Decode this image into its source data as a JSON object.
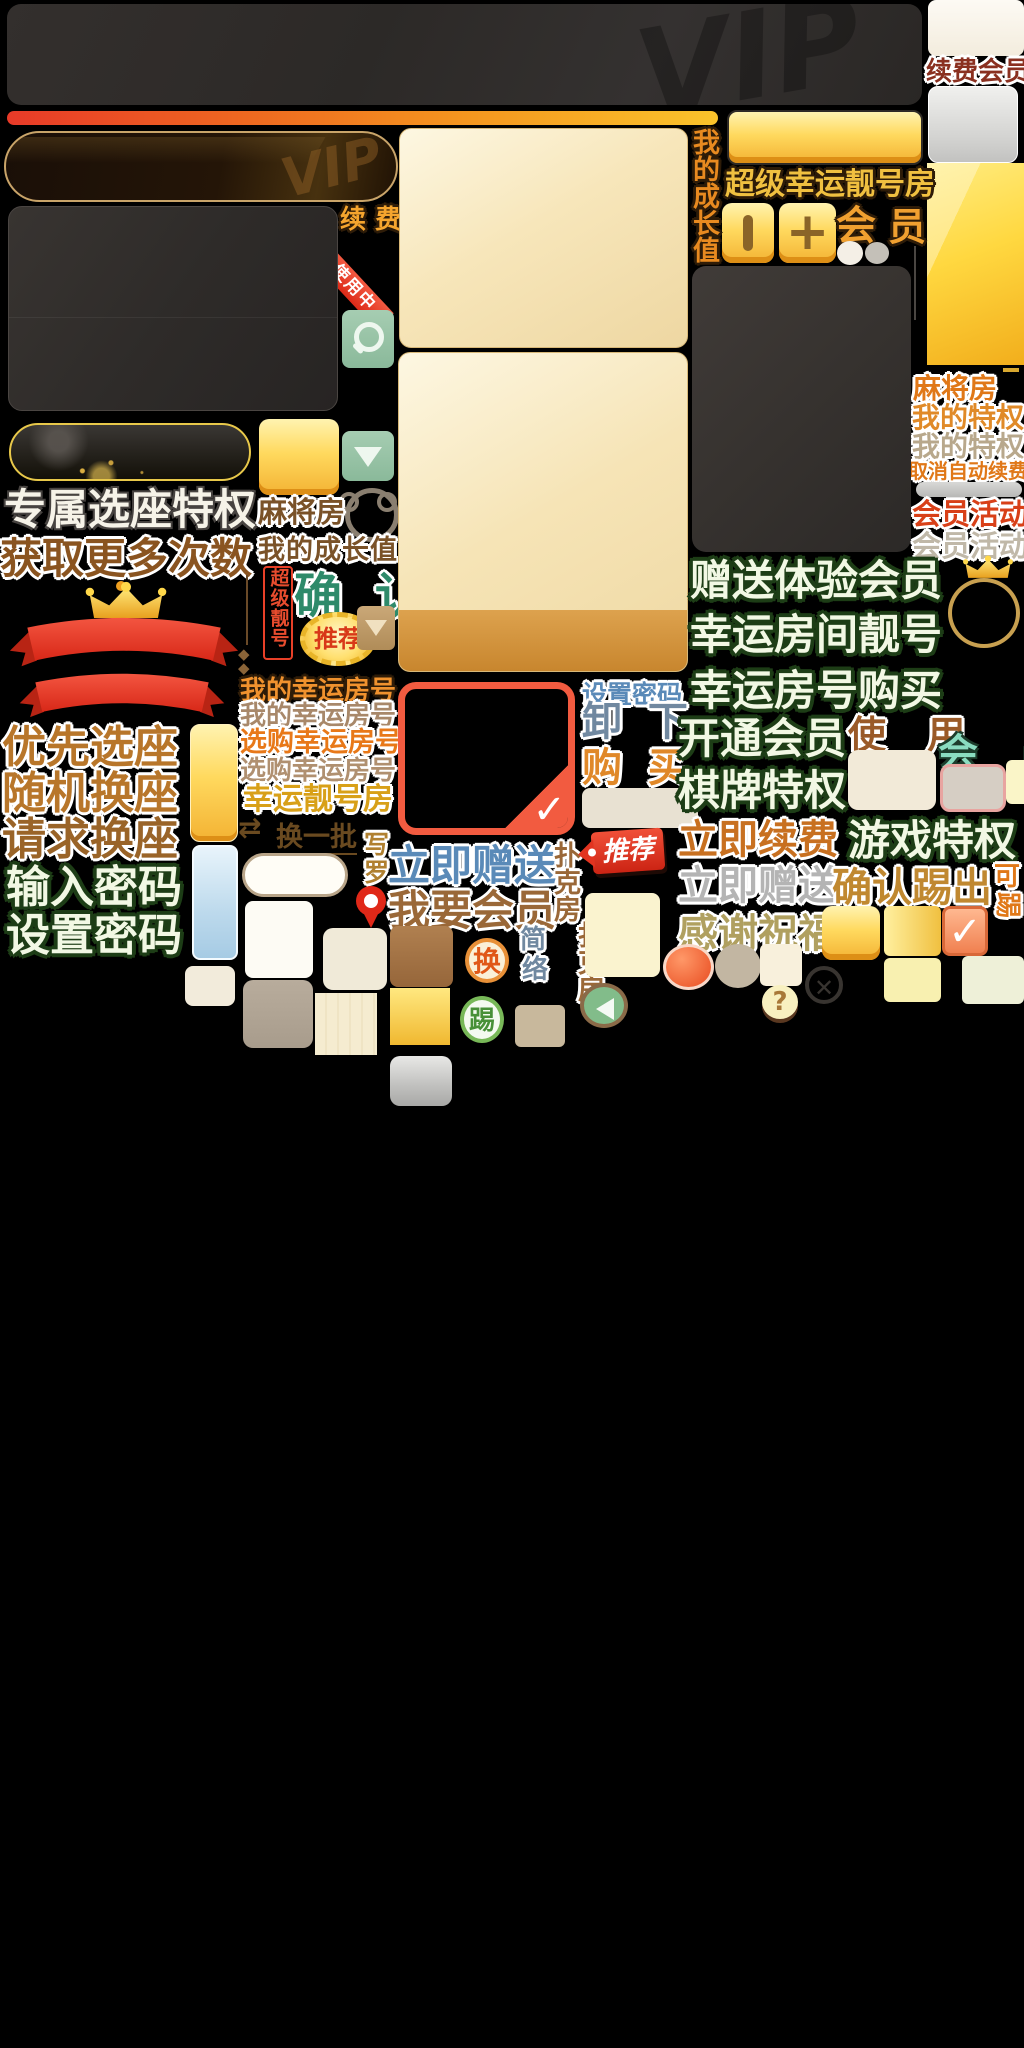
{
  "watermark": "VIP",
  "colors": {
    "accent_gold": "#f5c02a",
    "accent_orange": "#e8781e",
    "accent_red": "#e83a28",
    "teal_button": "#8ab99a",
    "text_green_light": "#f2f8e4",
    "text_green_outline": "#1d3d16",
    "text_brown": "#8a5a28",
    "text_blue": "#5a8ab8",
    "text_teal": "#2e8a6a",
    "panel_dark": "#322e2c",
    "panel_cream": "#f7e6ba",
    "panel_gold": "#ffd840"
  },
  "texts": {
    "xufei_small": "续 费",
    "shiyongzhong": "使用中",
    "zhuanshu_xuanzuo": "专属选座特权",
    "huoqu_cishu": "获取更多次数",
    "youxian_xuanzuo": "优先选座",
    "suiji_huanzuo": "随机换座",
    "qingqiu_huanzuo": "请求换座",
    "shuru_mima": "输入密码",
    "shezhi_mima_large": "设置密码",
    "majiang_mid": "麻将房",
    "chengzhang_mid": "我的成长值",
    "chaoji_lianghao_vert": "超级靓号",
    "queren": "确 认",
    "tuijian_badge": "推荐",
    "wode_xingyun_1": "我的幸运房号",
    "wode_xingyun_2": "我的幸运房号",
    "xuangou_xingyun_1": "选购幸运房号",
    "xuangou_xingyun_2": "选购幸运房号",
    "xingyun_lianghao_fang": "幸运靓号房",
    "huanyipi": "换一批",
    "char_xie": "写",
    "char_luo": "罗",
    "shezhi_mima_small": "设置密码",
    "xie_xia": "卸 下",
    "gou_mai": "购 买",
    "liji_zengsong_blue": "立即赠送",
    "woyao_huiyuan": "我要会员",
    "pukefang_1": "扑克房",
    "pukefang_2": "扑克房",
    "char_jian": "简",
    "char_luo2": "络",
    "tuijian_tag": "推荐",
    "xufei_huiyuan": "续费会员",
    "majiang_right": "麻将房",
    "wode_tequan_1": "我的特权",
    "wode_tequan_2": "我的特权",
    "quxiao_zidong_xufei": "取消自动续费",
    "huiyuan_huodong_1": "会员活动",
    "huiyuan_huodong_2": "会员活动",
    "zengsong_tiyan": "赠送体验会员",
    "xingyun_fangjian": "幸运房间靓号",
    "xingyun_goumai": "幸运房号购买",
    "kaitong_huiyuan": "开通会员",
    "shi_yong": "使 用",
    "hui_yuan_teal": "会 员",
    "qipai_tequan": "棋牌特权",
    "youxi_tequan": "游戏特权",
    "liji_xufei": "立即续费",
    "liji_zengsong_silver": "立即赠送",
    "queren_tichu": "确认踢出",
    "ke": "可",
    "ti_rot": "踢",
    "ganxie_zhufu": "感谢祝福",
    "chaoji_xingyun_fang": "超级幸运靓号房",
    "chengzhang_vert": "我的成长值",
    "hui": "会",
    "yuan": "员",
    "huan_coin": "换",
    "ti_coin": "踢",
    "plus": "+"
  },
  "icons": {
    "search-icon": "magnifier",
    "down-arrow-icon": "triangle-down",
    "swap-icon": "⇄",
    "diamond-icon": "◆",
    "check-icon": "✓",
    "close-icon": "✕",
    "question-icon": "?",
    "back-arrow-icon": "left-triangle",
    "pin-icon": "map-pin",
    "crown-icon": "crown",
    "ribbon-icon": "ribbon"
  }
}
